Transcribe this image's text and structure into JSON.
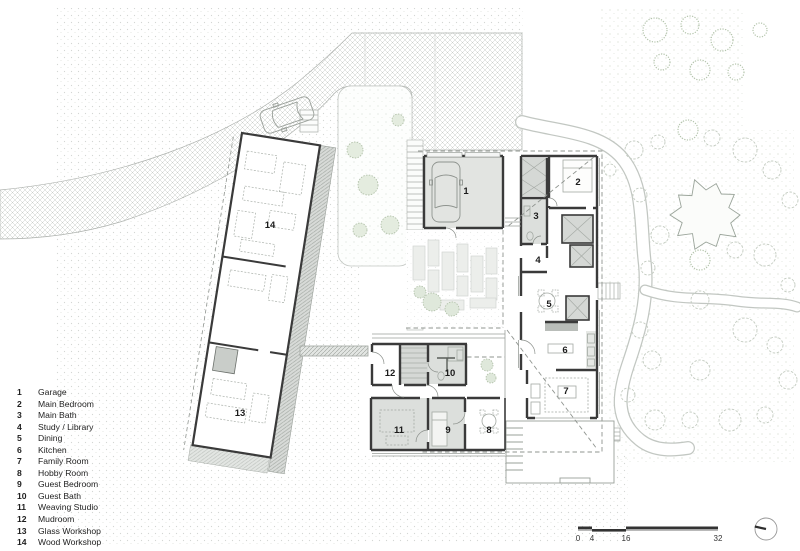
{
  "legend": {
    "items": [
      {
        "number": "1",
        "label": "Garage"
      },
      {
        "number": "2",
        "label": "Main Bedroom"
      },
      {
        "number": "3",
        "label": "Main Bath"
      },
      {
        "number": "4",
        "label": "Study / Library"
      },
      {
        "number": "5",
        "label": "Dining"
      },
      {
        "number": "6",
        "label": "Kitchen"
      },
      {
        "number": "7",
        "label": "Family Room"
      },
      {
        "number": "8",
        "label": "Hobby Room"
      },
      {
        "number": "9",
        "label": "Guest Bedroom"
      },
      {
        "number": "10",
        "label": "Guest Bath"
      },
      {
        "number": "11",
        "label": "Weaving Studio"
      },
      {
        "number": "12",
        "label": "Mudroom"
      },
      {
        "number": "13",
        "label": "Glass Workshop"
      },
      {
        "number": "14",
        "label": "Wood Workshop"
      }
    ]
  },
  "scale_bar": {
    "labels": [
      "0",
      "4",
      "16",
      "32"
    ]
  },
  "icons": {
    "north_arrow": "circle-with-pointer-line"
  },
  "colors": {
    "wall": "#3a3a3a",
    "room_gray": "#dcdfdc",
    "garage_fill": "#e2e4e1",
    "closet_gray": "#d5d8d5",
    "stipple_dot": "#aeb4ae",
    "plant_green": "#b3c2ab",
    "path_casing": "#c2c7c2",
    "dash_line": "#8f948f",
    "text": "#1c1c1c"
  }
}
